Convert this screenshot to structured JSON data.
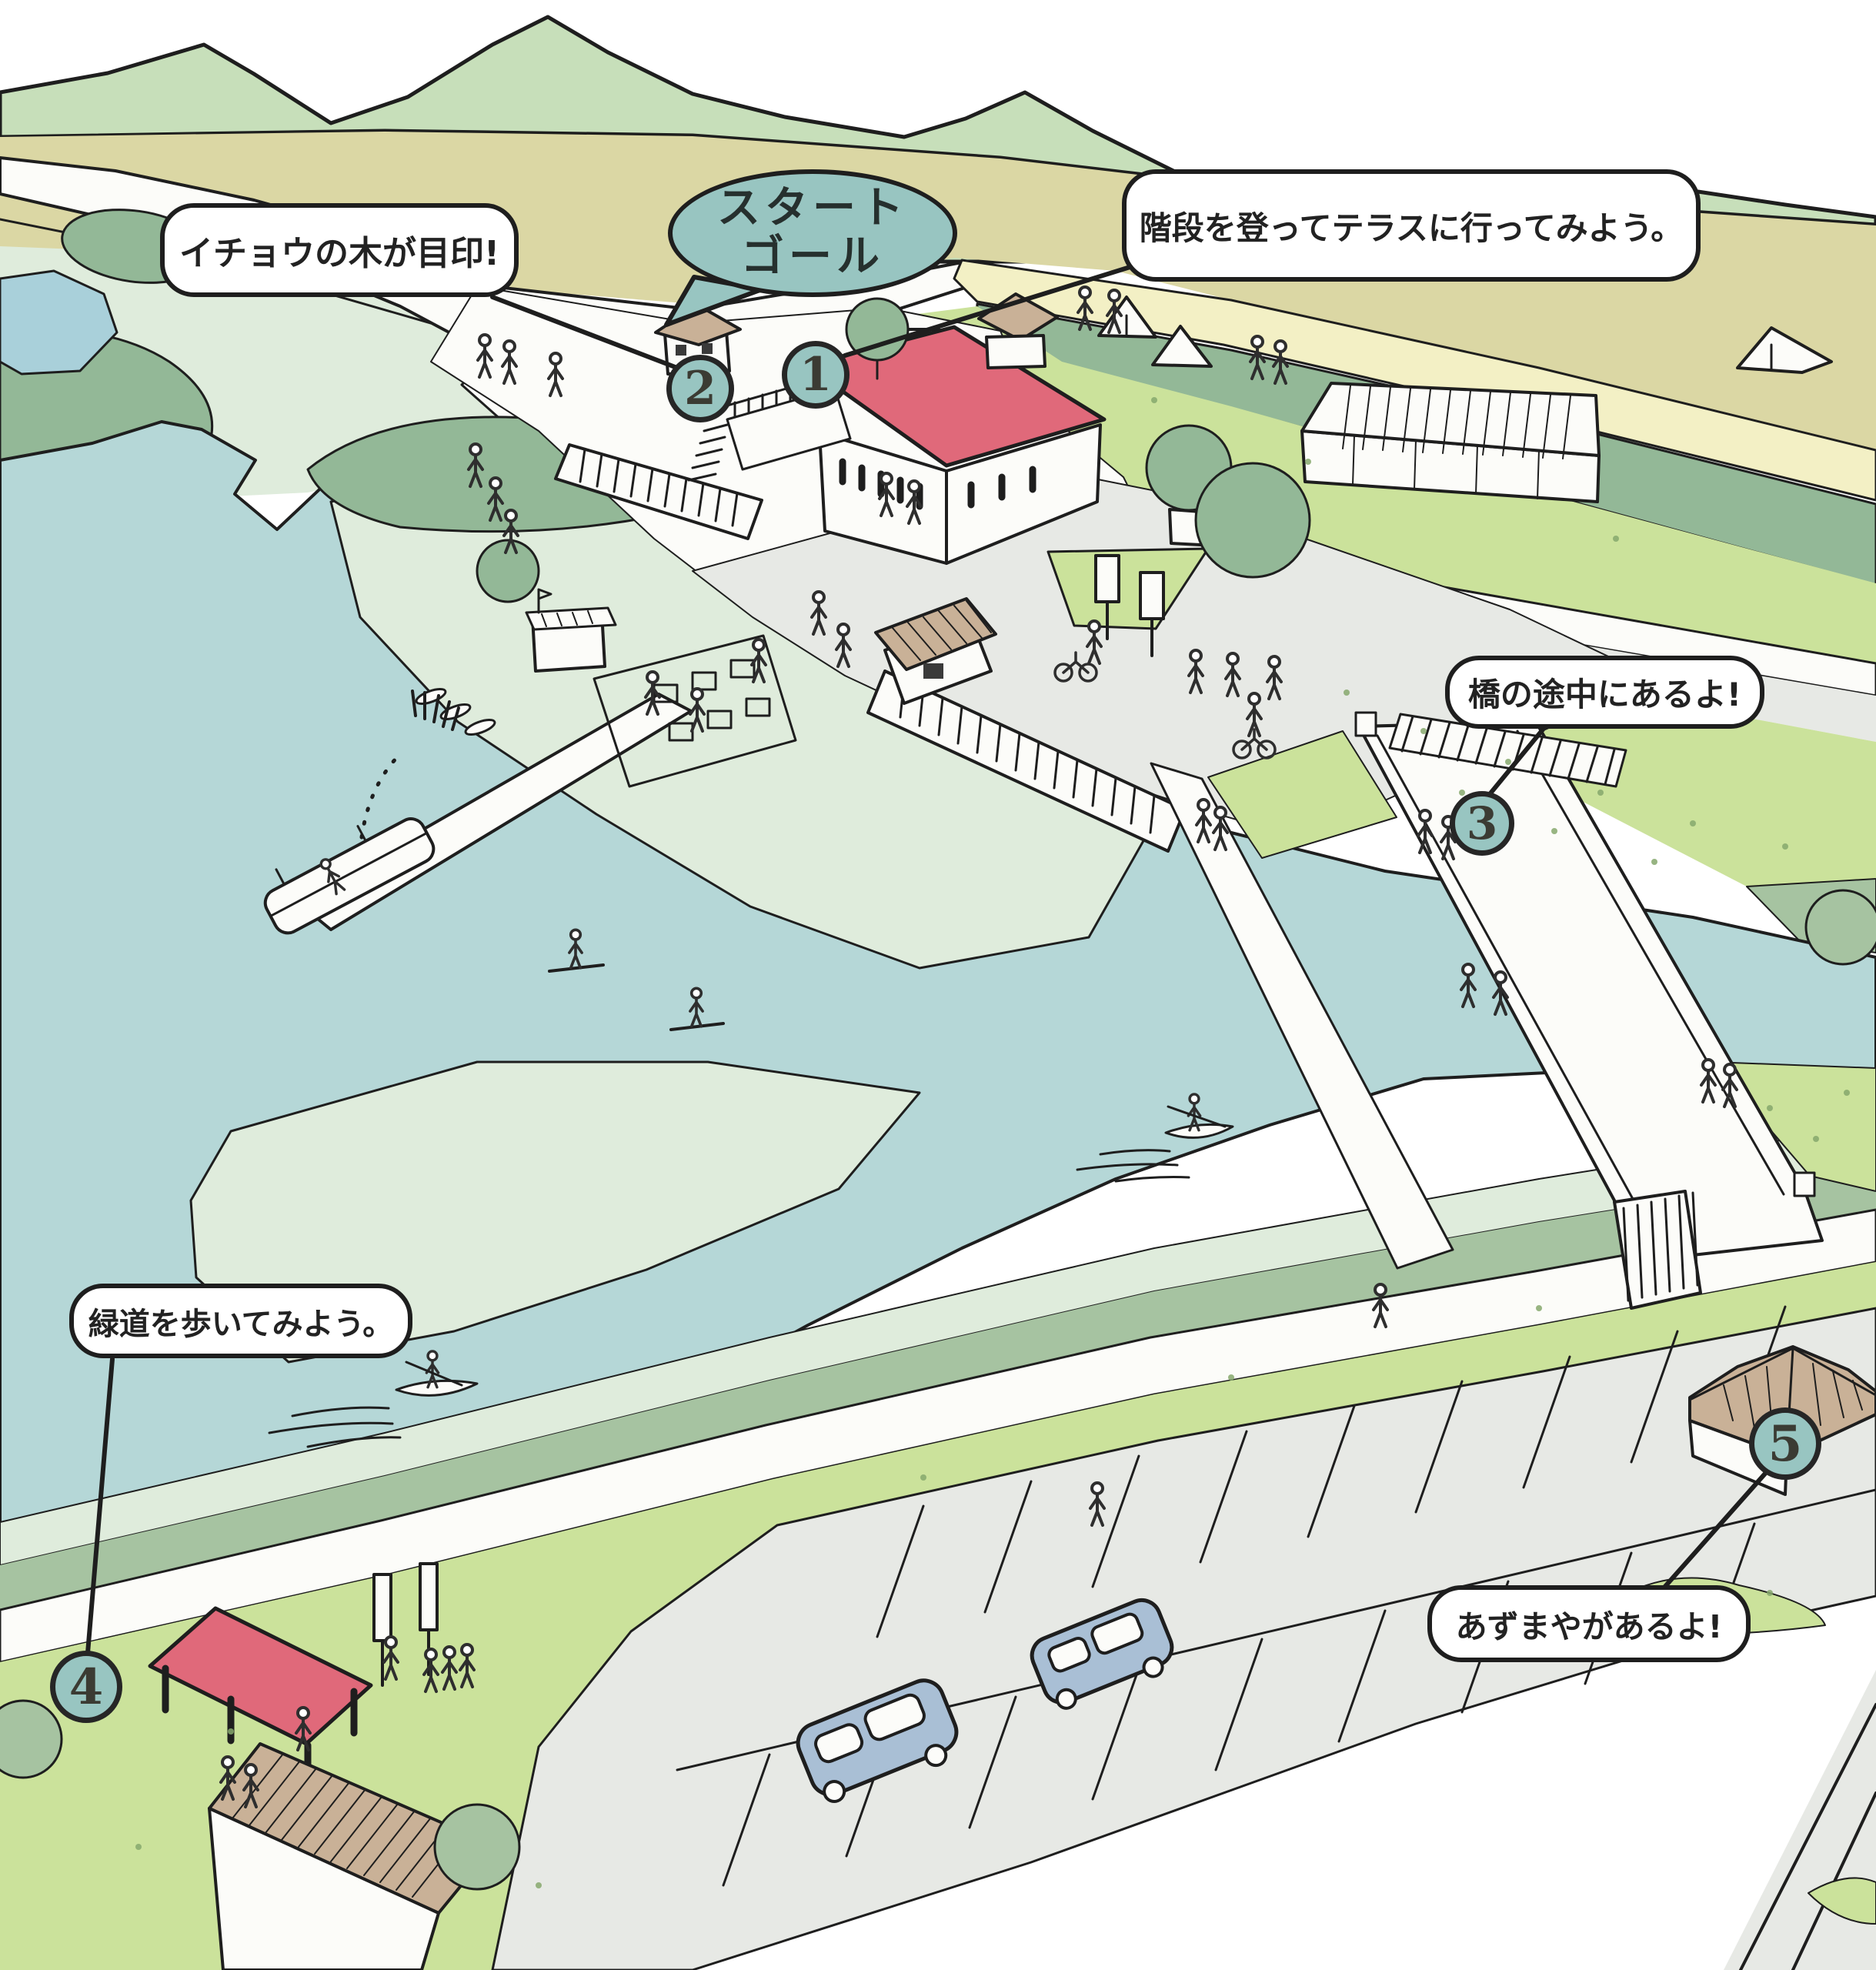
{
  "title_bubble": {
    "line1": "スタート",
    "line2": "ゴール"
  },
  "annotations": [
    {
      "point": "1",
      "text": "階段を登ってテラスに行ってみよう。"
    },
    {
      "point": "2",
      "text": "イチョウの木が目印!"
    },
    {
      "point": "3",
      "text": "橋の途中にあるよ!"
    },
    {
      "point": "4",
      "text": "緑道を歩いてみよう。"
    },
    {
      "point": "5",
      "text": "あずまやがあるよ!"
    }
  ],
  "markers": [
    {
      "number": "1"
    },
    {
      "number": "2"
    },
    {
      "number": "3"
    },
    {
      "number": "4"
    },
    {
      "number": "5"
    }
  ],
  "colors": {
    "outline": "#1e1e1e",
    "bubble-teal": "#98c5c1",
    "water": "#b5d7d7",
    "shallow": "#dfecdc",
    "grass": "#cbe29b",
    "sage": "#a6c3a1",
    "dark-sage": "#93b897",
    "khaki": "#dbd7a4",
    "field-yellow": "#f3f0c5",
    "mountain": "#c7dfba",
    "roof-red": "#e0697a",
    "roof-tan": "#c9b197",
    "path-grey": "#e7e9e5",
    "pond-blue": "#a9d0da",
    "car-blue": "#a9bfd5",
    "paper": "#ffffff"
  }
}
